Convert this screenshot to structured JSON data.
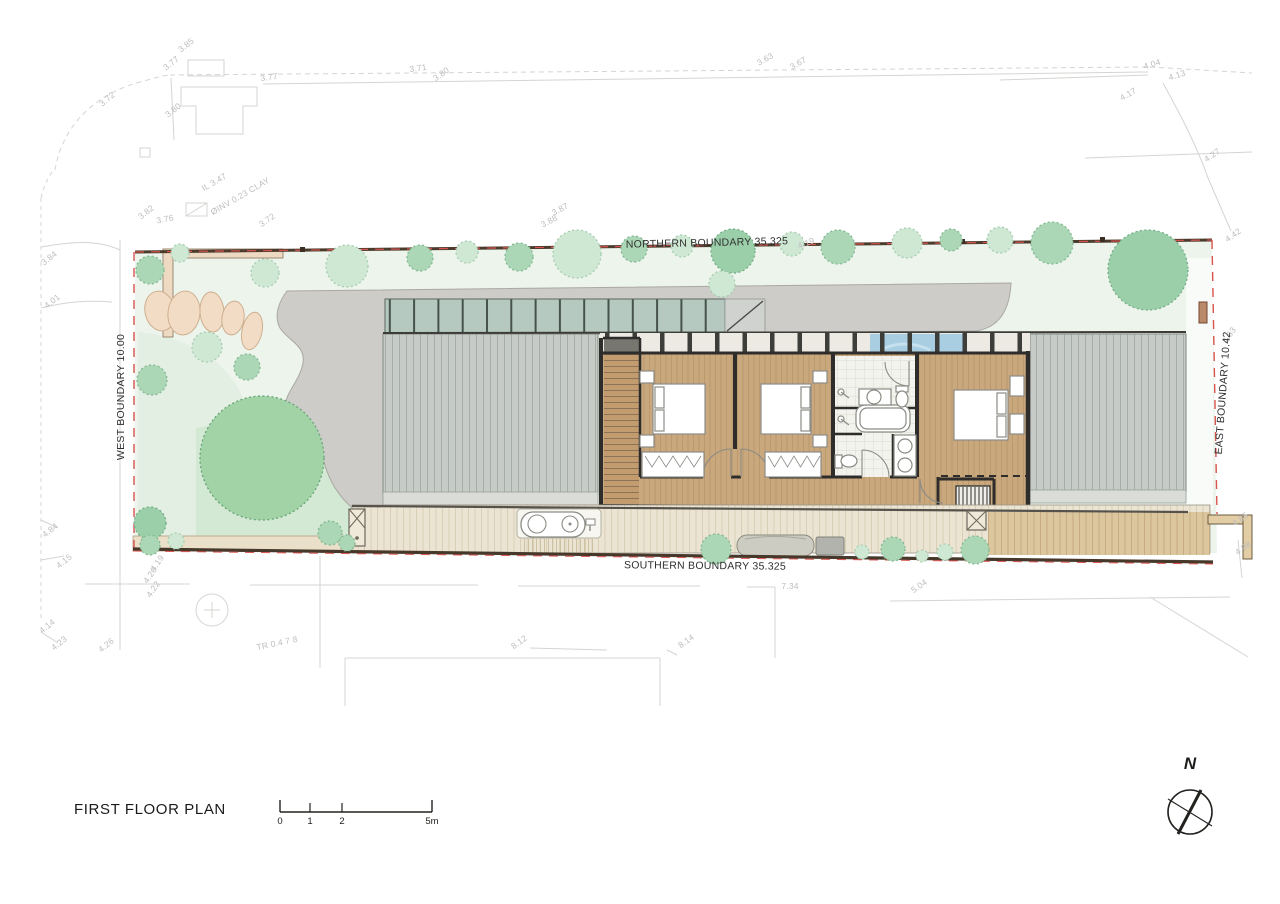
{
  "drawing": {
    "title": "FIRST FLOOR PLAN",
    "north_label": "N",
    "scale_ticks": [
      "0",
      "1",
      "2",
      "5m"
    ]
  },
  "boundaries": {
    "north": "NORTHERN BOUNDARY 35.325",
    "south": "SOUTHERN BOUNDARY 35.325",
    "west": "WEST BOUNDARY 10.00",
    "east": "EAST BOUNDARY 10.42"
  },
  "survey_marks": [
    {
      "t": "3.85",
      "x": 186,
      "y": 45,
      "r": -38
    },
    {
      "t": "3.77",
      "x": 171,
      "y": 63,
      "r": -38
    },
    {
      "t": "3.72",
      "x": 107,
      "y": 99,
      "r": -40
    },
    {
      "t": "3.80",
      "x": 173,
      "y": 110,
      "r": -38
    },
    {
      "t": "3.77",
      "x": 269,
      "y": 77,
      "r": -8
    },
    {
      "t": "3.71",
      "x": 418,
      "y": 68,
      "r": -8
    },
    {
      "t": "3.80",
      "x": 441,
      "y": 74,
      "r": -35
    },
    {
      "t": "3.63",
      "x": 765,
      "y": 59,
      "r": -30
    },
    {
      "t": "3.67",
      "x": 798,
      "y": 63,
      "r": -30
    },
    {
      "t": "4.04",
      "x": 1152,
      "y": 64,
      "r": -18
    },
    {
      "t": "4.13",
      "x": 1177,
      "y": 75,
      "r": -18
    },
    {
      "t": "4.17",
      "x": 1128,
      "y": 94,
      "r": -30
    },
    {
      "t": "4.27",
      "x": 1212,
      "y": 155,
      "r": -35
    },
    {
      "t": "4.42",
      "x": 1233,
      "y": 235,
      "r": -35
    },
    {
      "t": "3.84",
      "x": 49,
      "y": 258,
      "r": -38
    },
    {
      "t": "4.01",
      "x": 52,
      "y": 301,
      "r": -38
    },
    {
      "t": "3.82",
      "x": 146,
      "y": 212,
      "r": -38
    },
    {
      "t": "3.76",
      "x": 165,
      "y": 219,
      "r": -10
    },
    {
      "t": "IL 3.47",
      "x": 214,
      "y": 182,
      "r": -30
    },
    {
      "t": "ØINV 0.23 CLAY",
      "x": 240,
      "y": 196,
      "r": -30
    },
    {
      "t": "3.72",
      "x": 267,
      "y": 220,
      "r": -35
    },
    {
      "t": "3.87",
      "x": 560,
      "y": 209,
      "r": -28
    },
    {
      "t": "3.88",
      "x": 549,
      "y": 221,
      "r": -28
    },
    {
      "t": "4.19",
      "x": 806,
      "y": 243,
      "r": -20
    },
    {
      "t": "4.63",
      "x": 1229,
      "y": 335,
      "r": -55
    },
    {
      "t": "4.85",
      "x": 1240,
      "y": 519,
      "r": -35
    },
    {
      "t": "4.98",
      "x": 1243,
      "y": 548,
      "r": -35
    },
    {
      "t": "4.84",
      "x": 50,
      "y": 530,
      "r": -38
    },
    {
      "t": "4.15",
      "x": 64,
      "y": 561,
      "r": -38
    },
    {
      "t": "4.19",
      "x": 157,
      "y": 563,
      "r": -55
    },
    {
      "t": "4.20",
      "x": 150,
      "y": 575,
      "r": -55
    },
    {
      "t": "4.22",
      "x": 153,
      "y": 589,
      "r": -55
    },
    {
      "t": "4.14",
      "x": 47,
      "y": 626,
      "r": -38
    },
    {
      "t": "4.23",
      "x": 59,
      "y": 643,
      "r": -38
    },
    {
      "t": "4.26",
      "x": 106,
      "y": 645,
      "r": -38
    },
    {
      "t": "TR 0.4 7 8",
      "x": 277,
      "y": 643,
      "r": -12
    },
    {
      "t": "7.34",
      "x": 790,
      "y": 586,
      "r": 0
    },
    {
      "t": "5.04",
      "x": 919,
      "y": 586,
      "r": -35
    },
    {
      "t": "8.12",
      "x": 519,
      "y": 642,
      "r": -35
    },
    {
      "t": "8.14",
      "x": 686,
      "y": 641,
      "r": -35
    }
  ],
  "trees": [
    {
      "x": 150,
      "y": 270,
      "r": 14,
      "k": "mid"
    },
    {
      "x": 180,
      "y": 253,
      "r": 9,
      "k": "light"
    },
    {
      "x": 347,
      "y": 266,
      "r": 21,
      "k": "light"
    },
    {
      "x": 420,
      "y": 258,
      "r": 13,
      "k": "mid"
    },
    {
      "x": 467,
      "y": 252,
      "r": 11,
      "k": "light"
    },
    {
      "x": 519,
      "y": 257,
      "r": 14,
      "k": "mid"
    },
    {
      "x": 577,
      "y": 254,
      "r": 24,
      "k": "light"
    },
    {
      "x": 634,
      "y": 249,
      "r": 13,
      "k": "mid"
    },
    {
      "x": 682,
      "y": 246,
      "r": 11,
      "k": "light"
    },
    {
      "x": 733,
      "y": 251,
      "r": 22,
      "k": "deep"
    },
    {
      "x": 792,
      "y": 244,
      "r": 12,
      "k": "light"
    },
    {
      "x": 838,
      "y": 247,
      "r": 17,
      "k": "mid"
    },
    {
      "x": 907,
      "y": 243,
      "r": 15,
      "k": "light"
    },
    {
      "x": 951,
      "y": 240,
      "r": 11,
      "k": "mid"
    },
    {
      "x": 1000,
      "y": 240,
      "r": 13,
      "k": "light"
    },
    {
      "x": 1052,
      "y": 243,
      "r": 21,
      "k": "mid"
    },
    {
      "x": 1148,
      "y": 270,
      "r": 40,
      "k": "deep"
    },
    {
      "x": 722,
      "y": 284,
      "r": 13,
      "k": "light"
    },
    {
      "x": 265,
      "y": 273,
      "r": 14,
      "k": "light"
    },
    {
      "x": 152,
      "y": 380,
      "r": 15,
      "k": "mid"
    },
    {
      "x": 207,
      "y": 347,
      "r": 15,
      "k": "light"
    },
    {
      "x": 247,
      "y": 367,
      "r": 13,
      "k": "mid"
    },
    {
      "x": 150,
      "y": 523,
      "r": 16,
      "k": "deep"
    },
    {
      "x": 176,
      "y": 541,
      "r": 8,
      "k": "light"
    },
    {
      "x": 330,
      "y": 533,
      "r": 12,
      "k": "mid"
    },
    {
      "x": 262,
      "y": 458,
      "r": 62,
      "k": "big"
    },
    {
      "x": 150,
      "y": 545,
      "r": 10,
      "k": "mid"
    },
    {
      "x": 347,
      "y": 543,
      "r": 8,
      "k": "mid"
    },
    {
      "x": 716,
      "y": 549,
      "r": 15,
      "k": "mid"
    },
    {
      "x": 862,
      "y": 552,
      "r": 7,
      "k": "light"
    },
    {
      "x": 893,
      "y": 549,
      "r": 12,
      "k": "mid"
    },
    {
      "x": 922,
      "y": 556,
      "r": 6,
      "k": "light"
    },
    {
      "x": 945,
      "y": 552,
      "r": 8,
      "k": "light"
    },
    {
      "x": 975,
      "y": 550,
      "r": 14,
      "k": "mid"
    }
  ],
  "palette": {
    "tree_light": "#cfe8d4",
    "tree_light_edge": "#a6cdb0",
    "tree_mid": "#abd7b6",
    "tree_mid_edge": "#83b893",
    "tree_deep": "#9bcfa9",
    "tree_deep_edge": "#74ad86",
    "tree_big": "#a2d3a6",
    "tree_big_edge": "#66a376",
    "boundary_red": "#d9534f",
    "boundary_dark": "#4a3b2c",
    "roof_gray": "#c7cbc8",
    "concrete": "#cdccc8",
    "wood_floor": "#c9a87d",
    "deck_cream": "#ece4d2",
    "water_blue": "#a9cde1",
    "survey_text": "#bdbdbd",
    "label_text": "#2e2e2e"
  }
}
